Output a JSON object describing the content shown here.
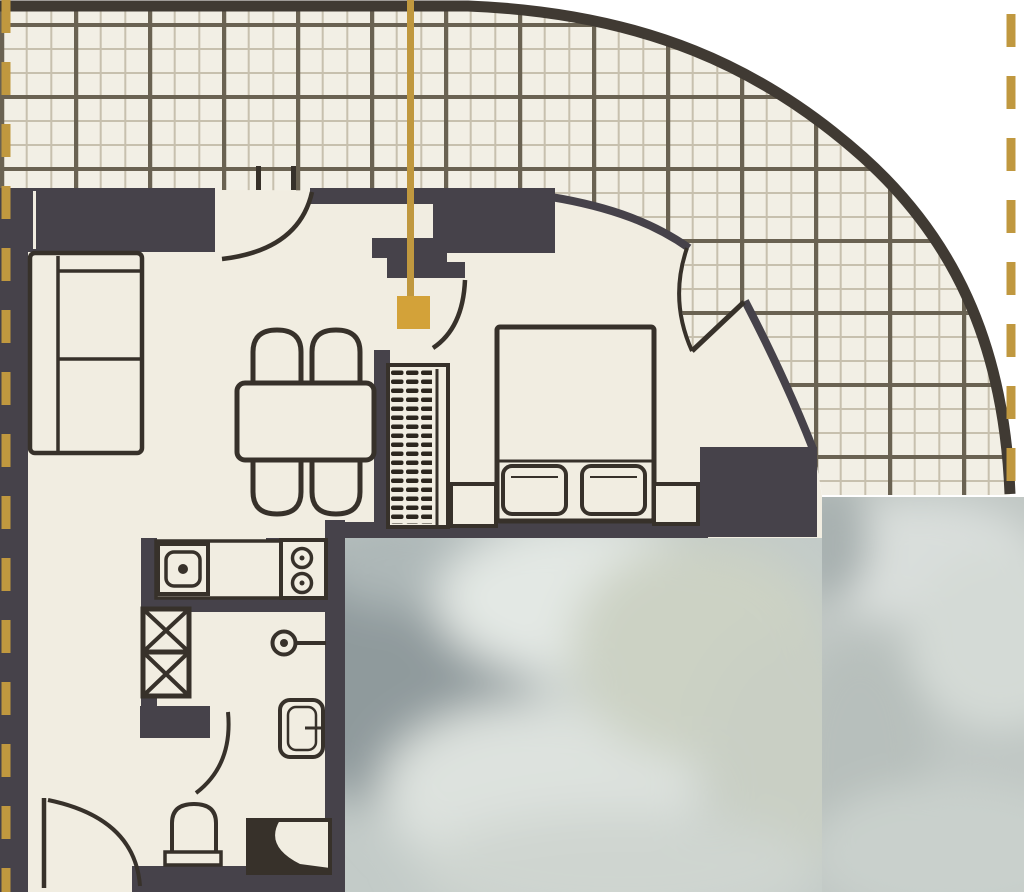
{
  "title": "Apartment floor plan with curved terrace and unit location marker",
  "scene_type": "architectural-floor-plan",
  "colors": {
    "outside": "#ffffff",
    "floor": "#f1ede1",
    "terrace_bg": "#f2efe5",
    "grid_fine": "#c7c0ae",
    "grid_major": "#6a6252",
    "wall": "#46424a",
    "ink": "#37312a",
    "outer": "#403a33",
    "accent": "#c0983f",
    "accent_square": "#d3a239",
    "blur_base_center": "#c3cbc8",
    "blur_base_right": "#c0c7c4",
    "blur_dark": "#8f9a9c",
    "blur_light": "#e3e8e4"
  },
  "marker": {
    "kind": "unit-location-marker",
    "line_x": 410,
    "line_top": 0,
    "line_bottom": 298,
    "square_x": 397,
    "square_y": 296,
    "square_size": 33
  },
  "boundary_dashes": {
    "left_x": 6,
    "left_span": [
      0,
      892
    ],
    "right_x": 1011,
    "right_span": [
      14,
      497
    ],
    "dash_length": 33,
    "gap_length": 29
  },
  "terrace": {
    "finish": "tile-grid",
    "major_cell_px": 74,
    "minor_divisions": 3
  },
  "rooms": [
    "living-dining",
    "bedroom",
    "kitchen",
    "bathroom",
    "entry-hall",
    "curved-terrace"
  ],
  "furniture_symbols": [
    "sofa",
    "dining-table",
    "dining-chair-x4",
    "wardrobe-hanging-rail",
    "double-bed",
    "pillow-x2",
    "nightstand-x2",
    "kitchen-sink",
    "stove-two-burner",
    "vent-shaft-x2",
    "washbasin",
    "toilet",
    "shower-unit"
  ],
  "door_symbols": [
    "terrace-door-arc",
    "entry-door-arc",
    "bedroom-terrace-double-door",
    "bathroom-door-arc",
    "inner-bathroom-door-arc",
    "lower-entrance-door-arc"
  ],
  "privacy_blur_regions": [
    {
      "x": 345,
      "y": 538,
      "w": 479,
      "h": 354
    },
    {
      "x": 822,
      "y": 497,
      "w": 202,
      "h": 395
    }
  ]
}
